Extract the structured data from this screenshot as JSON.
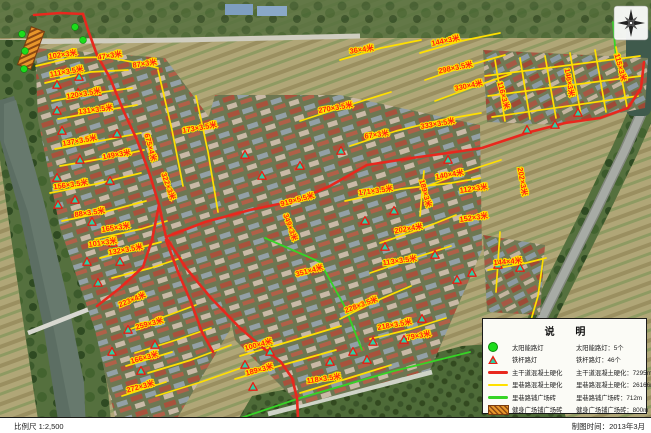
{
  "map": {
    "labels": [
      {
        "t": "102×3米",
        "x": 63,
        "y": 57,
        "r": -8
      },
      {
        "t": "47×3米",
        "x": 110,
        "y": 58,
        "r": -8
      },
      {
        "t": "87×3米",
        "x": 145,
        "y": 66,
        "r": -8
      },
      {
        "t": "111×3.5米",
        "x": 67,
        "y": 74,
        "r": -10
      },
      {
        "t": "120×3.5米",
        "x": 84,
        "y": 96,
        "r": -10
      },
      {
        "t": "131×3.5米",
        "x": 96,
        "y": 112,
        "r": -8
      },
      {
        "t": "137×3.5米",
        "x": 80,
        "y": 143,
        "r": -10
      },
      {
        "t": "149×3米",
        "x": 117,
        "y": 157,
        "r": -10
      },
      {
        "t": "156×3.5米",
        "x": 71,
        "y": 187,
        "r": -8
      },
      {
        "t": "88×3.5米",
        "x": 90,
        "y": 215,
        "r": -8
      },
      {
        "t": "165×3米",
        "x": 116,
        "y": 230,
        "r": -8
      },
      {
        "t": "675×4米",
        "x": 148,
        "y": 148,
        "r": 75
      },
      {
        "t": "173×3.5米",
        "x": 200,
        "y": 130,
        "r": -10
      },
      {
        "t": "322×3米",
        "x": 166,
        "y": 187,
        "r": 70
      },
      {
        "t": "36×4米",
        "x": 362,
        "y": 52,
        "r": -8
      },
      {
        "t": "144×3米",
        "x": 446,
        "y": 43,
        "r": -12
      },
      {
        "t": "298×3.5米",
        "x": 456,
        "y": 70,
        "r": -12
      },
      {
        "t": "330×4米",
        "x": 469,
        "y": 88,
        "r": -12
      },
      {
        "t": "270×3.5米",
        "x": 336,
        "y": 110,
        "r": -10
      },
      {
        "t": "115×3米",
        "x": 618,
        "y": 68,
        "r": 75
      },
      {
        "t": "146×3米",
        "x": 567,
        "y": 83,
        "r": 80
      },
      {
        "t": "116×3米",
        "x": 501,
        "y": 96,
        "r": 75
      },
      {
        "t": "67×3米",
        "x": 377,
        "y": 137,
        "r": -8
      },
      {
        "t": "333×3.5米",
        "x": 438,
        "y": 126,
        "r": -10
      },
      {
        "t": "140×4米",
        "x": 450,
        "y": 177,
        "r": -10
      },
      {
        "t": "189×3米",
        "x": 423,
        "y": 194,
        "r": 75
      },
      {
        "t": "171×3.5米",
        "x": 376,
        "y": 193,
        "r": -8
      },
      {
        "t": "112×3米",
        "x": 474,
        "y": 191,
        "r": -8
      },
      {
        "t": "152×3米",
        "x": 474,
        "y": 220,
        "r": -8
      },
      {
        "t": "202×4米",
        "x": 409,
        "y": 231,
        "r": -10
      },
      {
        "t": "919×5.5米",
        "x": 298,
        "y": 202,
        "r": -15
      },
      {
        "t": "349×3米",
        "x": 288,
        "y": 228,
        "r": 70
      },
      {
        "t": "202×3米",
        "x": 520,
        "y": 182,
        "r": 80
      },
      {
        "t": "101×3米",
        "x": 103,
        "y": 245,
        "r": -8
      },
      {
        "t": "132×3.5米",
        "x": 126,
        "y": 252,
        "r": -10
      },
      {
        "t": "223×4米",
        "x": 133,
        "y": 302,
        "r": -22
      },
      {
        "t": "259×3米",
        "x": 150,
        "y": 326,
        "r": -15
      },
      {
        "t": "351×4米",
        "x": 310,
        "y": 273,
        "r": -15
      },
      {
        "t": "113×3.5米",
        "x": 400,
        "y": 263,
        "r": -8
      },
      {
        "t": "228×3.5米",
        "x": 362,
        "y": 307,
        "r": -20
      },
      {
        "t": "218×3.5米",
        "x": 395,
        "y": 327,
        "r": -10
      },
      {
        "t": "79×3米",
        "x": 419,
        "y": 338,
        "r": -10
      },
      {
        "t": "144×4米",
        "x": 508,
        "y": 264,
        "r": -5
      },
      {
        "t": "166×3米",
        "x": 145,
        "y": 360,
        "r": -15
      },
      {
        "t": "272×3米",
        "x": 141,
        "y": 389,
        "r": -15
      },
      {
        "t": "100×4米",
        "x": 259,
        "y": 347,
        "r": -15
      },
      {
        "t": "189×3米",
        "x": 260,
        "y": 372,
        "r": -15
      },
      {
        "t": "118×3.5米",
        "x": 324,
        "y": 381,
        "r": -8
      }
    ],
    "markers": {
      "solar": [
        [
          22,
          34
        ],
        [
          25,
          51
        ],
        [
          24,
          69
        ],
        [
          75,
          27
        ],
        [
          83,
          40
        ]
      ],
      "pole": [
        [
          57,
          85
        ],
        [
          79,
          77
        ],
        [
          78,
          93
        ],
        [
          97,
          92
        ],
        [
          57,
          111
        ],
        [
          62,
          131
        ],
        [
          117,
          134
        ],
        [
          80,
          160
        ],
        [
          57,
          178
        ],
        [
          110,
          181
        ],
        [
          75,
          200
        ],
        [
          58,
          205
        ],
        [
          92,
          222
        ],
        [
          113,
          243
        ],
        [
          87,
          262
        ],
        [
          120,
          262
        ],
        [
          98,
          283
        ],
        [
          128,
          330
        ],
        [
          112,
          352
        ],
        [
          141,
          371
        ],
        [
          155,
          345
        ],
        [
          245,
          365
        ],
        [
          253,
          387
        ],
        [
          270,
          352
        ],
        [
          330,
          362
        ],
        [
          353,
          352
        ],
        [
          367,
          360
        ],
        [
          373,
          342
        ],
        [
          385,
          247
        ],
        [
          457,
          280
        ],
        [
          472,
          273
        ],
        [
          422,
          319
        ],
        [
          527,
          130
        ],
        [
          555,
          125
        ],
        [
          578,
          113
        ],
        [
          498,
          265
        ],
        [
          520,
          268
        ],
        [
          435,
          255
        ],
        [
          404,
          340
        ],
        [
          245,
          155
        ],
        [
          262,
          176
        ],
        [
          300,
          166
        ],
        [
          341,
          151
        ],
        [
          365,
          221
        ],
        [
          394,
          211
        ],
        [
          448,
          160
        ]
      ]
    },
    "roads": {
      "main": [
        [
          34,
          15,
          60,
          13,
          83,
          14
        ],
        [
          83,
          14,
          88,
          30,
          97,
          55,
          110,
          78,
          124,
          112,
          137,
          140,
          150,
          175,
          159,
          205,
          166,
          237
        ],
        [
          166,
          237,
          186,
          268,
          211,
          298,
          240,
          328,
          262,
          347,
          281,
          362,
          292,
          378,
          297,
          398,
          298,
          418
        ],
        [
          159,
          205,
          152,
          240,
          143,
          267,
          120,
          288,
          97,
          306
        ],
        [
          166,
          237,
          205,
          222,
          250,
          210,
          298,
          200,
          330,
          186,
          367,
          165,
          412,
          158,
          455,
          152,
          482,
          148,
          530,
          132,
          565,
          123
        ],
        [
          565,
          123,
          600,
          118,
          628,
          108,
          641,
          88,
          644,
          62
        ],
        [
          166,
          240,
          178,
          272,
          191,
          302,
          202,
          332,
          213,
          352
        ]
      ],
      "alley": [
        [
          36,
          66,
          70,
          58,
          105,
          57,
          138,
          63,
          158,
          68
        ],
        [
          45,
          83,
          90,
          72,
          128,
          70
        ],
        [
          52,
          101,
          96,
          93,
          132,
          88
        ],
        [
          58,
          119,
          101,
          111,
          137,
          105
        ],
        [
          55,
          149,
          100,
          141,
          141,
          133
        ],
        [
          60,
          166,
          106,
          158,
          144,
          150
        ],
        [
          50,
          193,
          96,
          184,
          141,
          173
        ],
        [
          62,
          221,
          101,
          213,
          146,
          201
        ],
        [
          95,
          239,
          141,
          229,
          167,
          221
        ],
        [
          100,
          258,
          131,
          250,
          161,
          242
        ],
        [
          112,
          278,
          151,
          268,
          181,
          258
        ],
        [
          125,
          331,
          161,
          318,
          196,
          305
        ],
        [
          135,
          353,
          176,
          340,
          211,
          328
        ],
        [
          148,
          373,
          191,
          360,
          231,
          345
        ],
        [
          156,
          396,
          201,
          382,
          241,
          368
        ],
        [
          158,
          70,
          172,
          130,
          183,
          186
        ],
        [
          196,
          96,
          208,
          152,
          218,
          212
        ],
        [
          340,
          60,
          381,
          48,
          421,
          40
        ],
        [
          420,
          53,
          461,
          41,
          500,
          33
        ],
        [
          425,
          80,
          466,
          66,
          505,
          55
        ],
        [
          435,
          101,
          473,
          87,
          511,
          74
        ],
        [
          300,
          121,
          346,
          106,
          391,
          92
        ],
        [
          350,
          146,
          396,
          131,
          441,
          120,
          481,
          113
        ],
        [
          420,
          189,
          461,
          173,
          501,
          160
        ],
        [
          345,
          201,
          401,
          189,
          451,
          183,
          480,
          178
        ],
        [
          424,
          171,
          420,
          216
        ],
        [
          380,
          243,
          421,
          229,
          456,
          215
        ],
        [
          370,
          273,
          411,
          259,
          451,
          246
        ],
        [
          340,
          319,
          376,
          301,
          411,
          286
        ],
        [
          370,
          339,
          411,
          329,
          446,
          318
        ],
        [
          240,
          356,
          291,
          341,
          341,
          326
        ],
        [
          235,
          379,
          286,
          364,
          336,
          350
        ],
        [
          300,
          393,
          346,
          379,
          391,
          365
        ],
        [
          126,
          366,
          172,
          352
        ],
        [
          122,
          396,
          166,
          382
        ],
        [
          495,
          60,
          505,
          121
        ],
        [
          520,
          58,
          530,
          119
        ],
        [
          545,
          56,
          556,
          118
        ],
        [
          570,
          53,
          581,
          115
        ],
        [
          595,
          50,
          606,
          112
        ],
        [
          616,
          47,
          627,
          107
        ],
        [
          485,
          76,
          640,
          56
        ],
        [
          488,
          96,
          641,
          76
        ],
        [
          492,
          117,
          638,
          96
        ],
        [
          488,
          270,
          526,
          263,
          546,
          258
        ],
        [
          500,
          232,
          496,
          292
        ],
        [
          543,
          260,
          538,
          296,
          531,
          320
        ]
      ],
      "plaza": [
        [
          265,
          238,
          320,
          262,
          345,
          307,
          362,
          350
        ],
        [
          232,
          421,
          300,
          398,
          390,
          372,
          470,
          352
        ],
        [
          613,
          22,
          616,
          58
        ]
      ]
    }
  },
  "legend": {
    "title": "说  明",
    "items": [
      {
        "symbol": "solar-light",
        "label": "太阳能路灯",
        "value": "太阳能路灯：5个"
      },
      {
        "symbol": "pole-light",
        "label": "铁杆路灯",
        "value": "铁杆路灯：46个"
      },
      {
        "symbol": "main-road",
        "label": "主干道混凝土硬化",
        "value": "主干道混凝土硬化：7295m"
      },
      {
        "symbol": "alley-road",
        "label": "里巷路混凝土硬化",
        "value": "里巷路混凝土硬化：26166m"
      },
      {
        "symbol": "plaza-road",
        "label": "里巷路铺广场砖",
        "value": "里巷路铺广场砖：712m"
      },
      {
        "symbol": "fitness-plaza",
        "label": "健身广场铺广场砖",
        "value": "健身广场铺广场砖：800m"
      }
    ]
  },
  "footer": {
    "scale": "比例尺  1:2,500",
    "date": "制图时间：2013年3月"
  },
  "colors": {
    "main_road": "#e8281e",
    "alley_road": "#ffe000",
    "plaza_road": "#36d426",
    "label_text": "#ff1e14",
    "label_halo": "#ffe400",
    "solar_marker": "#1cdd1c",
    "pole_marker": "#2ecfa6"
  }
}
